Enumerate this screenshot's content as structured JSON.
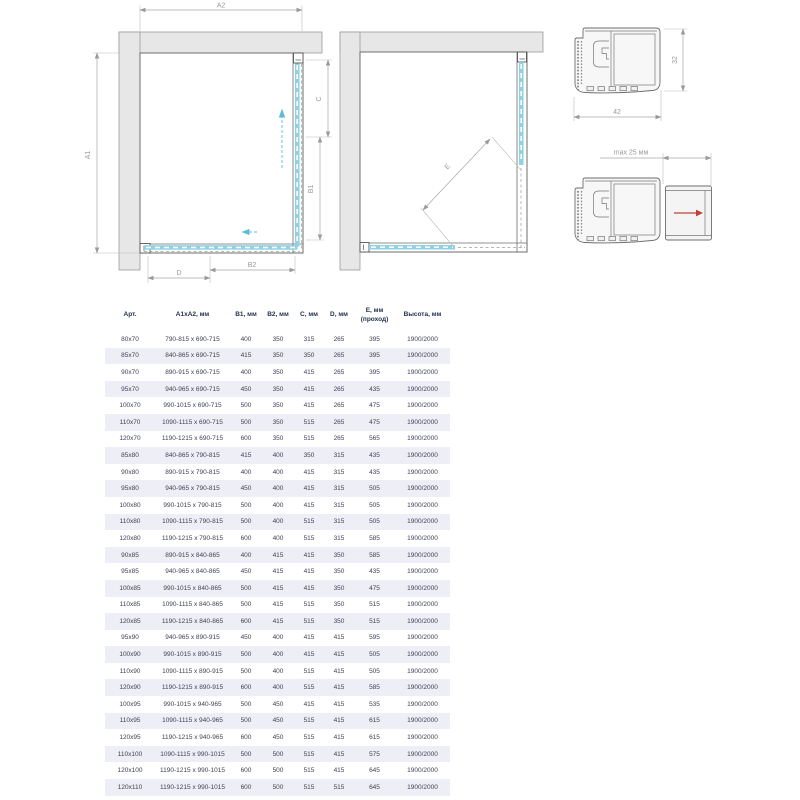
{
  "diagrams": {
    "plan_closed": {
      "labels": {
        "a2": "A2",
        "a1": "A1",
        "c": "C",
        "b1": "B1",
        "d": "D",
        "b2": "B2"
      }
    },
    "plan_open": {
      "labels": {
        "e": "E"
      }
    },
    "profile_main": {
      "width": "42",
      "height": "32"
    },
    "profile_adjustable": {
      "max_extension": "max 25 мм"
    }
  },
  "table": {
    "headers": [
      "Арт.",
      "A1xA2, мм",
      "B1, мм",
      "B2, мм",
      "C, мм",
      "D, мм",
      "E, мм (проход)",
      "Высота, мм"
    ],
    "rows": [
      [
        "80x70",
        "790-815 x 690-715",
        "400",
        "350",
        "315",
        "265",
        "395",
        "1900/2000"
      ],
      [
        "85x70",
        "840-865 x 690-715",
        "415",
        "350",
        "350",
        "265",
        "395",
        "1900/2000"
      ],
      [
        "90x70",
        "890-915 x 690-715",
        "400",
        "350",
        "415",
        "265",
        "395",
        "1900/2000"
      ],
      [
        "95x70",
        "940-965 x 690-715",
        "450",
        "350",
        "415",
        "265",
        "435",
        "1900/2000"
      ],
      [
        "100x70",
        "990-1015 x 690-715",
        "500",
        "350",
        "415",
        "265",
        "475",
        "1900/2000"
      ],
      [
        "110x70",
        "1090-1115 x 690-715",
        "500",
        "350",
        "515",
        "265",
        "475",
        "1900/2000"
      ],
      [
        "120x70",
        "1190-1215 x 690-715",
        "600",
        "350",
        "515",
        "265",
        "565",
        "1900/2000"
      ],
      [
        "85x80",
        "840-865 x 790-815",
        "415",
        "400",
        "350",
        "315",
        "435",
        "1900/2000"
      ],
      [
        "90x80",
        "890-915 x 790-815",
        "400",
        "400",
        "415",
        "315",
        "435",
        "1900/2000"
      ],
      [
        "95x80",
        "940-965 x 790-815",
        "450",
        "400",
        "415",
        "315",
        "505",
        "1900/2000"
      ],
      [
        "100x80",
        "990-1015 x 790-815",
        "500",
        "400",
        "415",
        "315",
        "505",
        "1900/2000"
      ],
      [
        "110x80",
        "1090-1115 x 790-815",
        "500",
        "400",
        "515",
        "315",
        "505",
        "1900/2000"
      ],
      [
        "120x80",
        "1190-1215 x 790-815",
        "600",
        "400",
        "515",
        "315",
        "585",
        "1900/2000"
      ],
      [
        "90x85",
        "890-915 x 840-865",
        "400",
        "415",
        "415",
        "350",
        "585",
        "1900/2000"
      ],
      [
        "95x85",
        "940-965 x 840-865",
        "450",
        "415",
        "415",
        "350",
        "435",
        "1900/2000"
      ],
      [
        "100x85",
        "990-1015 x 840-865",
        "500",
        "415",
        "415",
        "350",
        "475",
        "1900/2000"
      ],
      [
        "110x85",
        "1090-1115 x 840-865",
        "500",
        "415",
        "515",
        "350",
        "515",
        "1900/2000"
      ],
      [
        "120x85",
        "1190-1215 x 840-865",
        "600",
        "415",
        "515",
        "350",
        "515",
        "1900/2000"
      ],
      [
        "95x90",
        "940-965 x 890-915",
        "450",
        "400",
        "415",
        "415",
        "595",
        "1900/2000"
      ],
      [
        "100x90",
        "990-1015 x 890-915",
        "500",
        "400",
        "415",
        "415",
        "505",
        "1900/2000"
      ],
      [
        "110x90",
        "1090-1115 x 890-915",
        "500",
        "400",
        "515",
        "415",
        "505",
        "1900/2000"
      ],
      [
        "120x90",
        "1190-1215 x 890-915",
        "600",
        "400",
        "515",
        "415",
        "585",
        "1900/2000"
      ],
      [
        "100x95",
        "990-1015 x 940-965",
        "500",
        "450",
        "415",
        "415",
        "535",
        "1900/2000"
      ],
      [
        "110x95",
        "1090-1115 x 940-965",
        "500",
        "450",
        "515",
        "415",
        "615",
        "1900/2000"
      ],
      [
        "120x95",
        "1190-1215 x 940-965",
        "600",
        "450",
        "515",
        "415",
        "615",
        "1900/2000"
      ],
      [
        "110x100",
        "1090-1115 x 990-1015",
        "500",
        "500",
        "515",
        "415",
        "575",
        "1900/2000"
      ],
      [
        "120x100",
        "1190-1215 x 990-1015",
        "600",
        "500",
        "515",
        "415",
        "645",
        "1900/2000"
      ],
      [
        "120x110",
        "1190-1215 x 990-1015",
        "600",
        "500",
        "515",
        "515",
        "645",
        "1900/2000"
      ]
    ]
  },
  "colors": {
    "glass": "#8fd2e2",
    "glass_arrow": "#5bbcd9",
    "adjust_arrow_red": "#bf4138",
    "row_alt": "#eeeef6",
    "header_text": "#233052",
    "body_text": "#3f4254",
    "dimension_line": "#a8a8a8",
    "wall_fill": "#e7e7e7",
    "outline": "#6e6e6e"
  }
}
